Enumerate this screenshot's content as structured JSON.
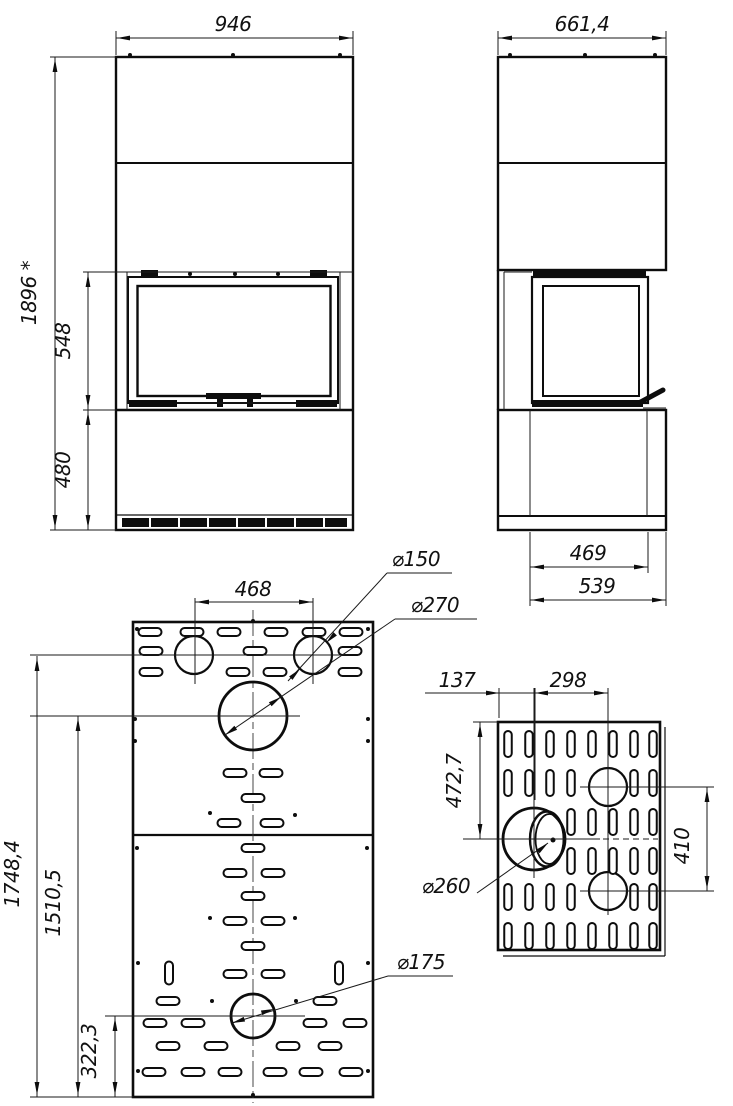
{
  "front_view": {
    "width": "946",
    "overall_height": "1896 *",
    "firebox_height": "548",
    "base_height": "480"
  },
  "side_view": {
    "depth": "661,4",
    "firebox_depth": "469",
    "base_depth": "539"
  },
  "rear_view": {
    "flue_spacing": "468",
    "flue_diameter_top": "⌀150",
    "flue_diameter_center": "⌀270",
    "flue_axis_height": "1748,4",
    "center_flue_height": "1510,5",
    "lower_flue_height": "322,3",
    "flue_diameter_lower": "⌀175"
  },
  "side_panel_view": {
    "edge_to_axis": "137",
    "axis_spacing": "298",
    "top_to_axis": "472,7",
    "vertical_axis_spacing": "410",
    "side_flue_diameter": "⌀260"
  }
}
